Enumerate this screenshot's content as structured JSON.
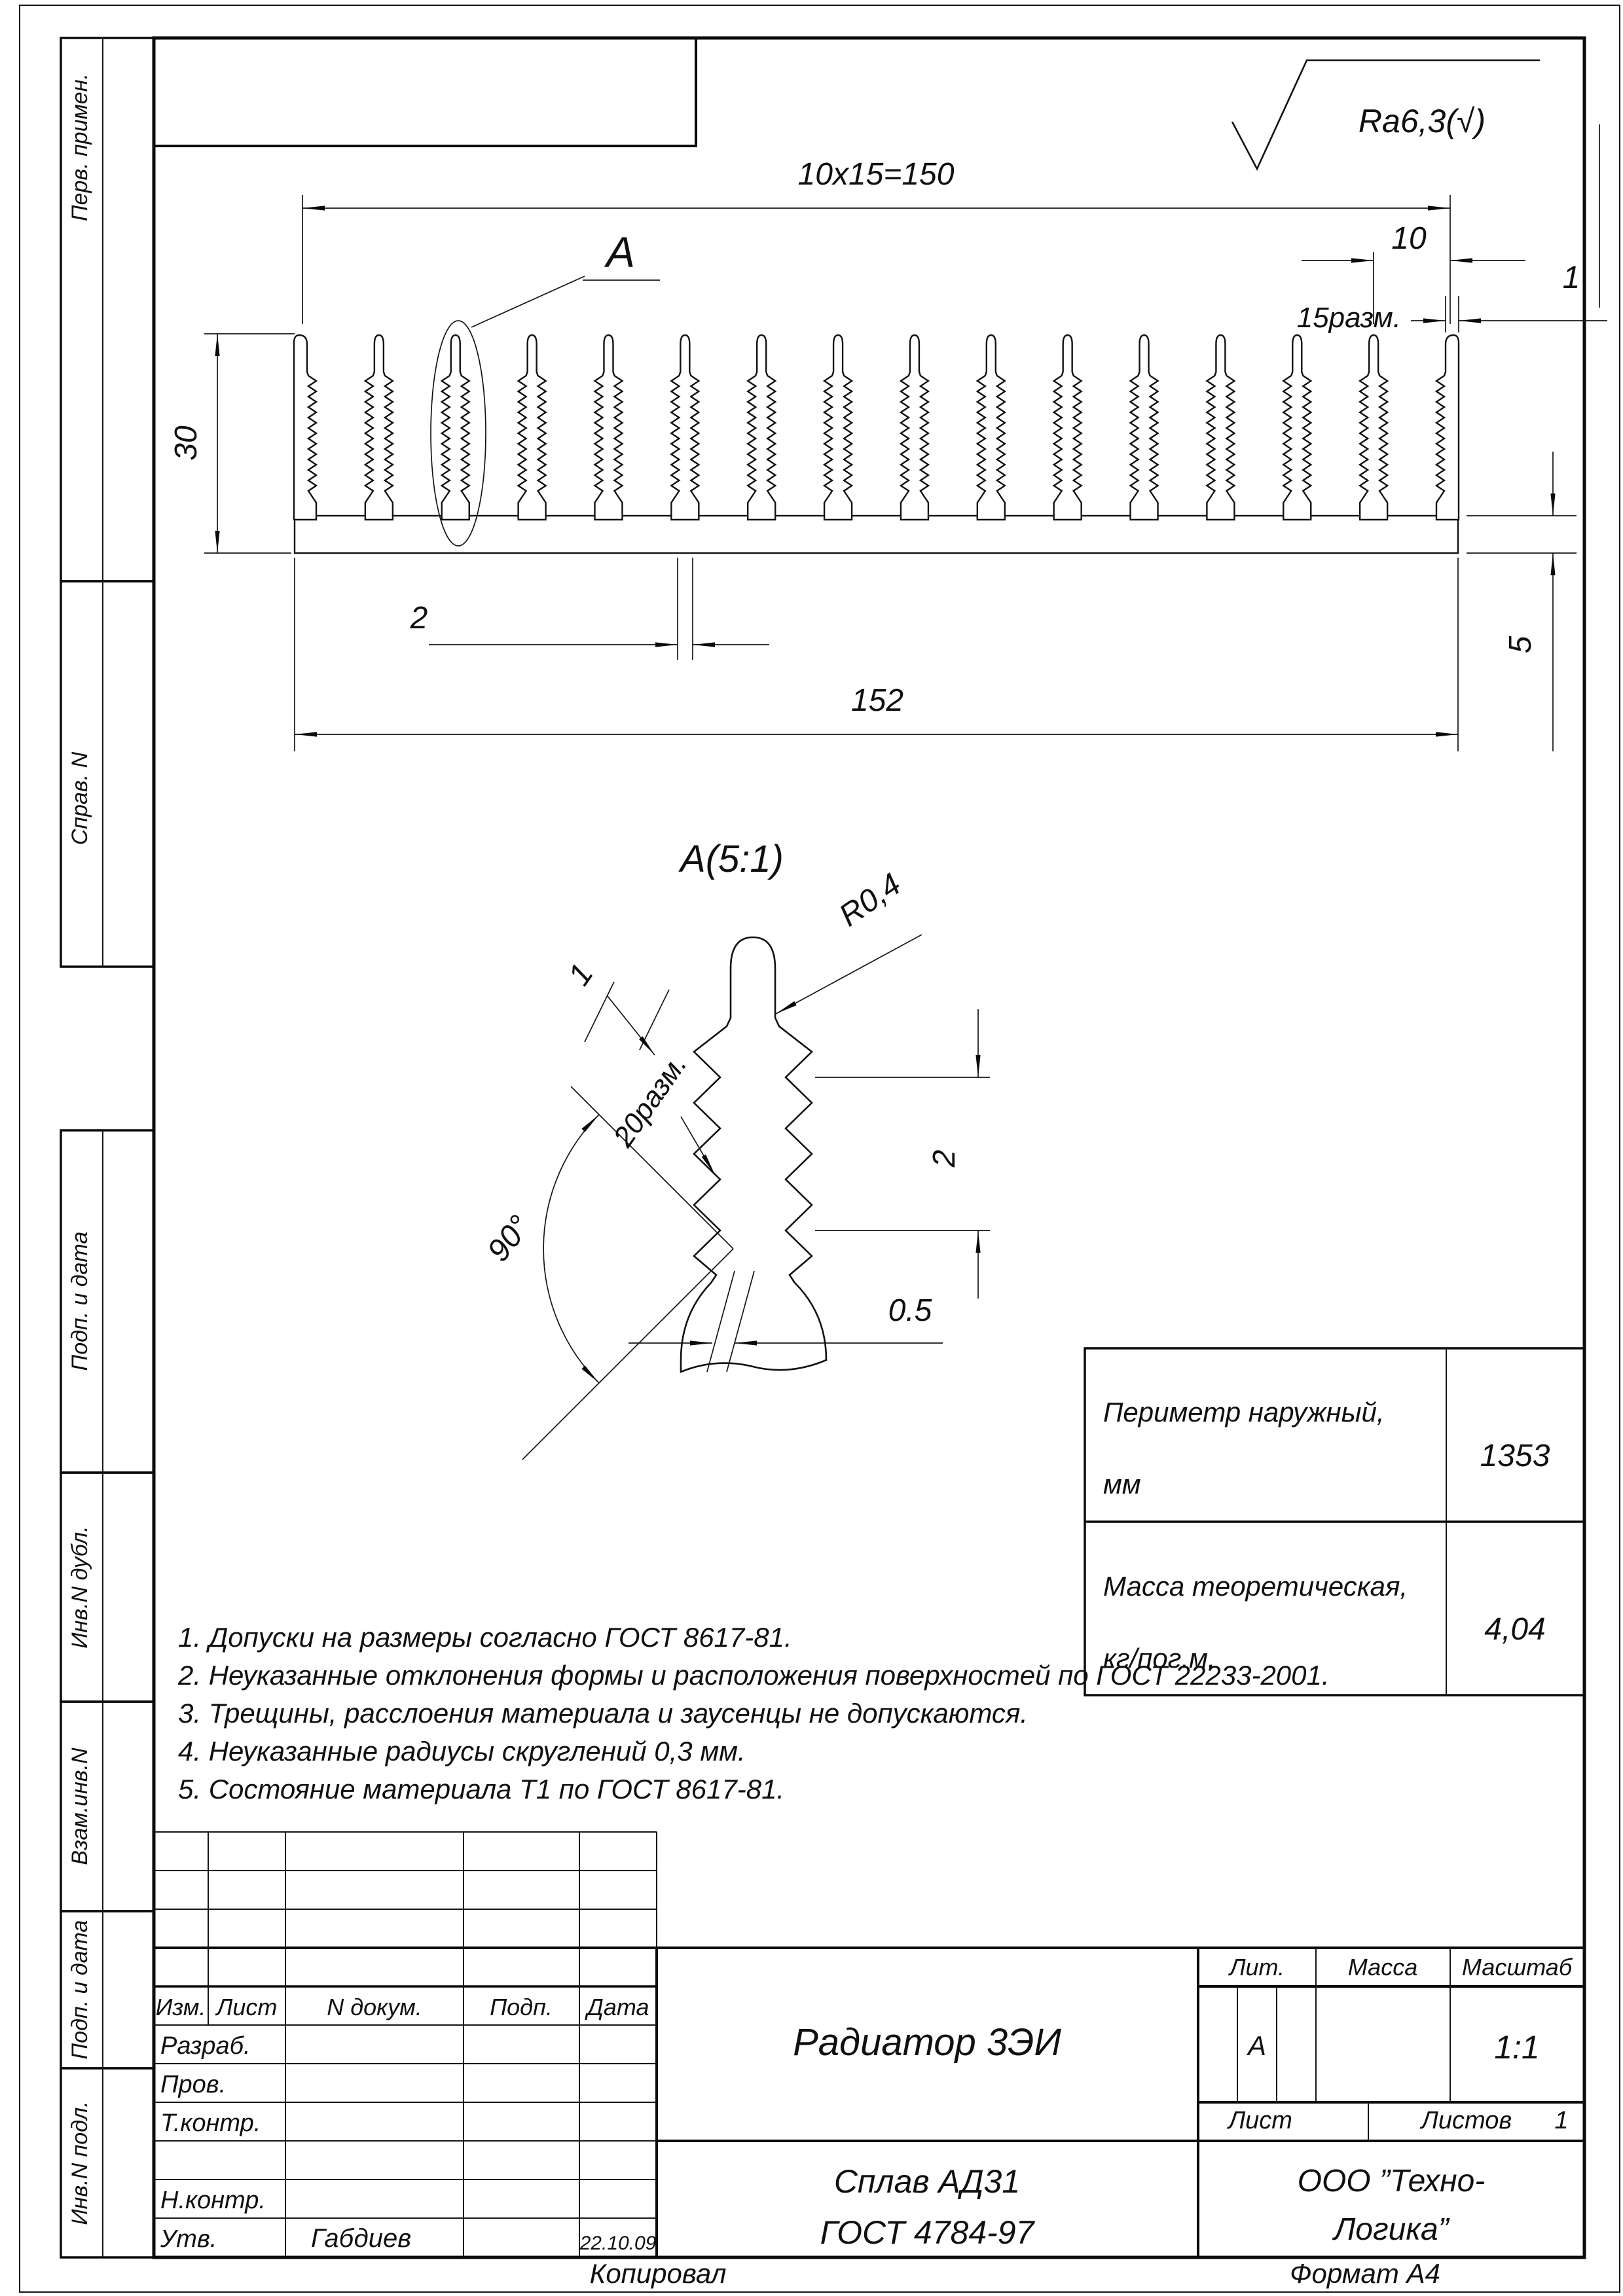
{
  "roughness": "Ra6,3(√)",
  "main_view": {
    "callout_label": "A",
    "dim_total": "10x15=150",
    "dim_pitch": "10",
    "dim_places": "15разм.",
    "dim_tip": "1",
    "dim_height": "30",
    "dim_base": "5",
    "dim_thickness": "2",
    "dim_width": "152"
  },
  "detail_view": {
    "title": "A(5:1)",
    "dim_radius": "R0,4",
    "dim_tip": "1",
    "dim_places": "20разм.",
    "dim_pitch": "2",
    "dim_offset": "0.5",
    "dim_angle": "90°"
  },
  "spec_table": {
    "rows": [
      {
        "label1": "Периметр наружный,",
        "label2": "мм",
        "value": "1353"
      },
      {
        "label1": "Масса теоретическая,",
        "label2": "кг/пог.м.",
        "value": "4,04"
      }
    ]
  },
  "notes": [
    "1. Допуски на размеры согласно ГОСТ 8617-81.",
    "2. Неуказанные отклонения формы и расположения поверхностей по ГОСТ 22233-2001.",
    "3. Трещины, расслоения материала и заусенцы не допускаются.",
    "4. Неуказанные радиусы скруглений 0,3 мм.",
    "5. Состояние материала Т1 по ГОСТ 8617-81."
  ],
  "margin_labels": [
    "Перв. примен.",
    "Справ. N",
    "Подп. и дата",
    "Инв.N дубл.",
    "Взам.инв.N",
    "Подп. и дата",
    "Инв.N подл."
  ],
  "title_block": {
    "header_cols": [
      "Изм.",
      "Лист",
      "N докум.",
      "Подп.",
      "Дата"
    ],
    "row_labels": [
      "Разраб.",
      "Пров.",
      "Т.контр.",
      "Н.контр.",
      "Утв."
    ],
    "approver": "Габдиев",
    "date": "22.10.09",
    "doc_title": "Радиатор 3ЭИ",
    "material_line1": "Сплав АД31",
    "material_line2": "ГОСТ 4784-97",
    "lit_label": "Лит.",
    "mass_label": "Масса",
    "scale_label": "Масштаб",
    "lit_value": "А",
    "scale_value": "1:1",
    "sheet_label": "Лист",
    "sheets_label": "Листов",
    "sheets_value": "1",
    "company_line1": "ООО ”Техно-",
    "company_line2": "Логика”"
  },
  "footer": {
    "left": "Копировал",
    "right": "Формат А4"
  }
}
